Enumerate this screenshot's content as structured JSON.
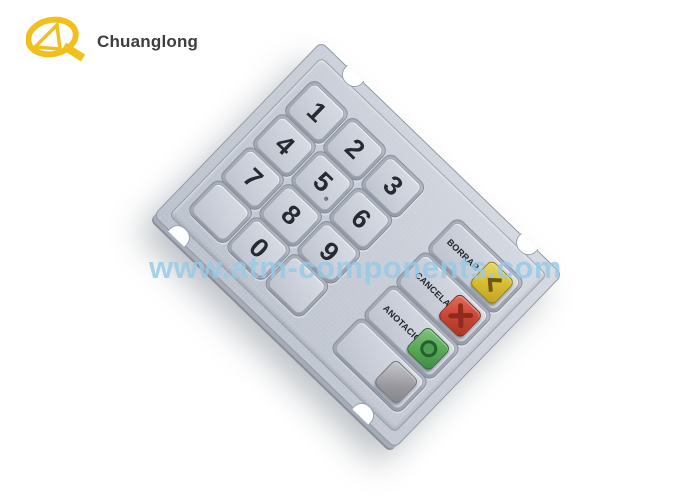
{
  "brand": {
    "name": "Chuanglong",
    "logo_color": "#F2C01C",
    "name_color": "#3E3E40"
  },
  "watermark": {
    "text": "www.atm-components.com",
    "color": "#96C9E6"
  },
  "product": {
    "description": "Silver metal ATM EPP keypad (Spanish layout), rotated on white background",
    "plate_color": "#C7CCD6",
    "digit_keys": [
      {
        "label": "1"
      },
      {
        "label": "2"
      },
      {
        "label": "3"
      },
      {
        "label": "4"
      },
      {
        "label": "5"
      },
      {
        "label": "6"
      },
      {
        "label": "7"
      },
      {
        "label": "8"
      },
      {
        "label": "9"
      },
      {
        "label": ""
      },
      {
        "label": "0"
      },
      {
        "label": ""
      }
    ],
    "function_keys": [
      {
        "label": "BORRAR",
        "button_color": "#D9BD35",
        "glyph": "chevron-left"
      },
      {
        "label": "CANCELAR",
        "button_color": "#CB4636",
        "glyph": "x-cross"
      },
      {
        "label": "ANOTACION",
        "button_color": "#57AA58",
        "glyph": "circle"
      },
      {
        "label": "",
        "button_color": "#98989E",
        "glyph": "blank"
      }
    ]
  }
}
